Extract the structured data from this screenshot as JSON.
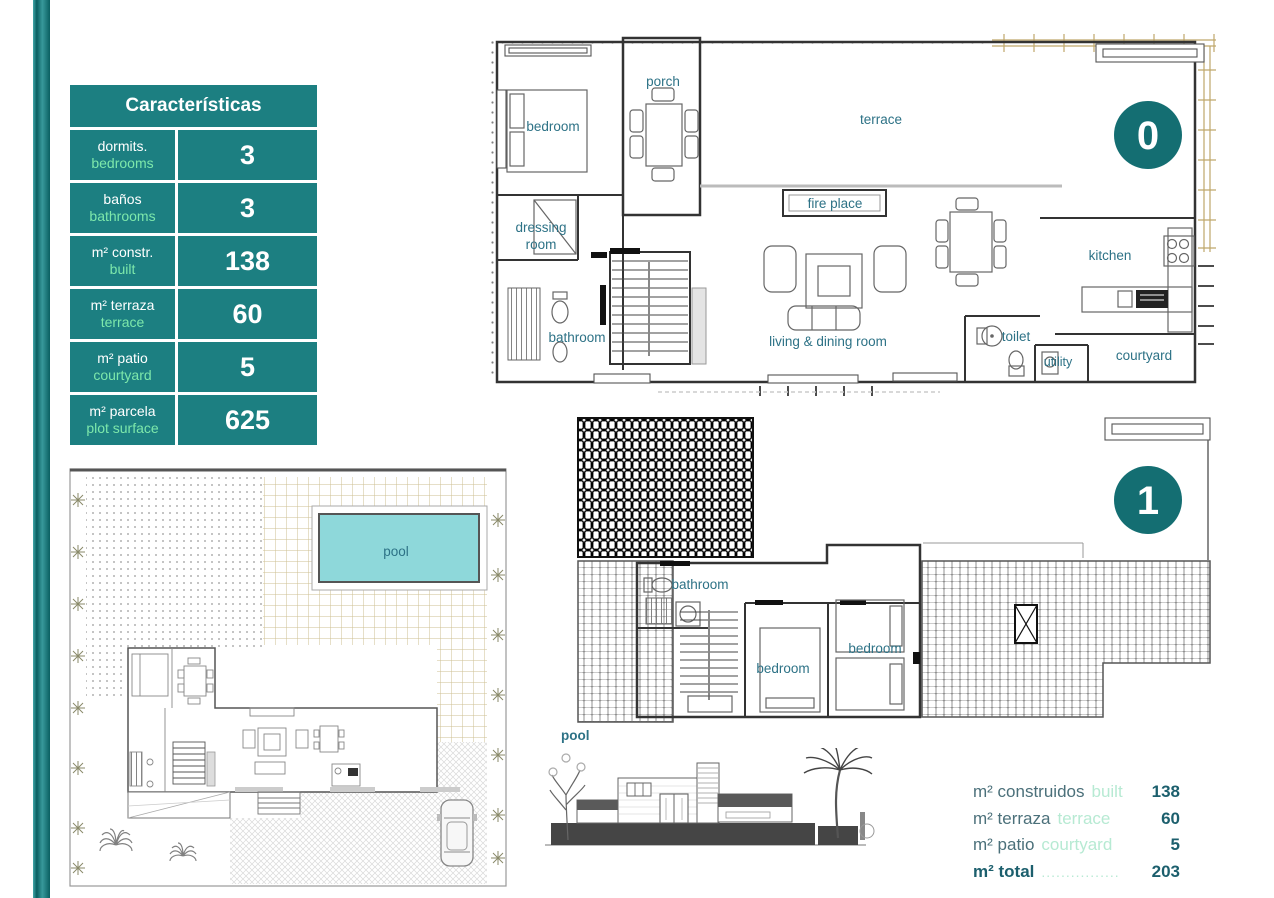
{
  "colors": {
    "teal": "#1c7f81",
    "badge": "#146e72",
    "mint": "#7de8ab",
    "label": "#2d7286",
    "sum-es": "#4b707a",
    "sum-en": "#b7ead3",
    "sum-val": "#1c5f6d",
    "tan": "#cdbf92",
    "pool": "#8ed8da"
  },
  "table": {
    "title": "Características",
    "rows": [
      {
        "es": "dormits.",
        "en": "bedrooms",
        "value": "3"
      },
      {
        "es": "baños",
        "en": "bathrooms",
        "value": "3"
      },
      {
        "es": "m² constr.",
        "en": "built",
        "value": "138"
      },
      {
        "es": "m² terraza",
        "en": "terrace",
        "value": "60"
      },
      {
        "es": "m² patio",
        "en": "courtyard",
        "value": "5"
      },
      {
        "es": "m² parcela",
        "en": "plot surface",
        "value": "625"
      }
    ]
  },
  "floor0": {
    "badge": "0",
    "labels": {
      "porch": "porch",
      "bedroom": "bedroom",
      "terrace": "terrace",
      "fireplace": "fire place",
      "dressing1": "dressing",
      "dressing2": "room",
      "bathroom": "bathroom",
      "living": "living & dining room",
      "kitchen": "kitchen",
      "toilet": "toilet",
      "utility": "utility",
      "courtyard": "courtyard"
    }
  },
  "floor1": {
    "badge": "1",
    "labels": {
      "bathroom": "bathroom",
      "bedroom_center": "bedroom",
      "bedroom_right": "bedroom",
      "pool": "pool"
    }
  },
  "site": {
    "pool": "pool"
  },
  "summary": {
    "rows": [
      {
        "es": "m² construidos",
        "en": "built",
        "value": "138"
      },
      {
        "es": "m² terraza",
        "en": "terrace",
        "value": "60"
      },
      {
        "es": "m² patio",
        "en": "courtyard",
        "value": "5"
      }
    ],
    "total": {
      "es": "m² total",
      "dots": "................",
      "value": "203"
    }
  }
}
